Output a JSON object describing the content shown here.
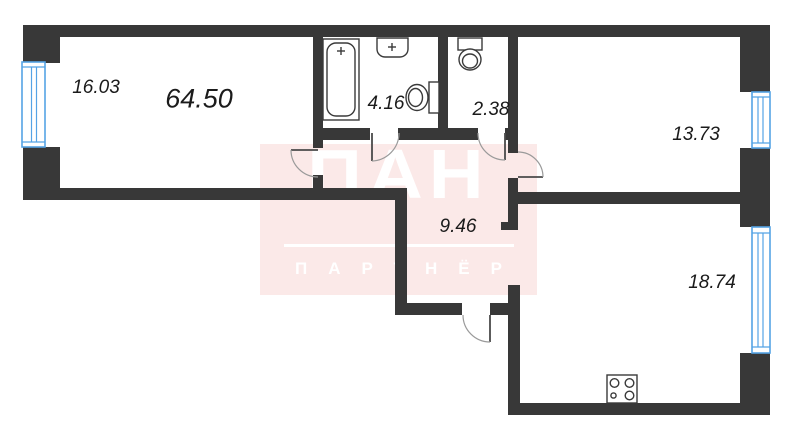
{
  "floor_plan": {
    "total_area": "64.50",
    "rooms": {
      "living_room": {
        "area": "16.03"
      },
      "bathroom": {
        "area": "4.16"
      },
      "toilet": {
        "area": "2.38"
      },
      "bedroom": {
        "area": "13.73"
      },
      "hallway": {
        "area": "9.46"
      },
      "kitchen_living_room": {
        "area": "18.74"
      }
    },
    "watermark": {
      "logo_text": "ПАН",
      "subtitle_text": "ПАРТНЁР"
    },
    "colors": {
      "wall": "#383838",
      "window_frame": "#55a3e5",
      "fixture_line": "#3a3a3a",
      "door_arc": "#9a9a9a",
      "label_text": "#1b1b1b",
      "watermark_background": "#fbe9e8",
      "watermark_text": "#ffffff"
    }
  }
}
